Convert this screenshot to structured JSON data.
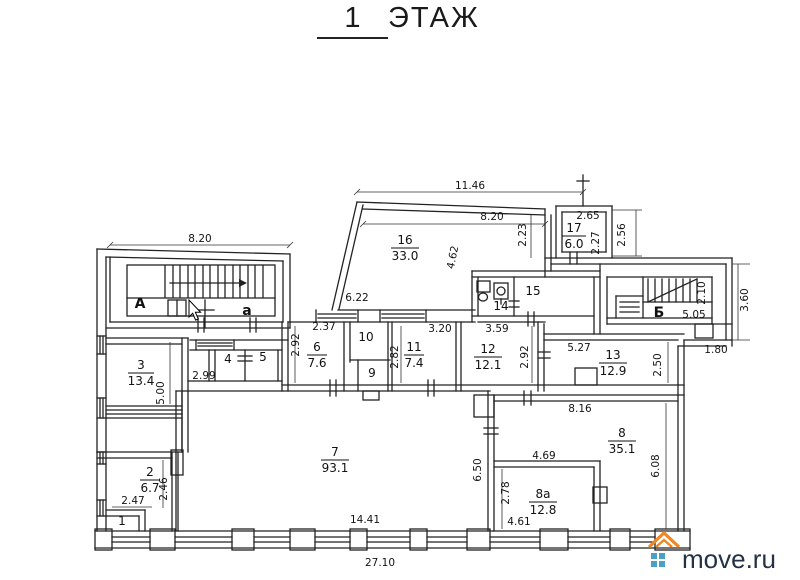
{
  "title": {
    "number": "1",
    "word": "ЭТАЖ"
  },
  "stairs": {
    "left_main": "А",
    "left_small": "а",
    "right": "Б"
  },
  "rooms": {
    "r1": {
      "n": "1"
    },
    "r2": {
      "n": "2",
      "a": "6.7"
    },
    "r3": {
      "n": "3",
      "a": "13.4"
    },
    "r4": {
      "n": "4"
    },
    "r5": {
      "n": "5"
    },
    "r6": {
      "n": "6",
      "a": "7.6"
    },
    "r7": {
      "n": "7",
      "a": "93.1"
    },
    "r8": {
      "n": "8",
      "a": "35.1"
    },
    "r8a": {
      "n": "8а",
      "a": "12.8"
    },
    "r9": {
      "n": "9"
    },
    "r10": {
      "n": "10"
    },
    "r11": {
      "n": "11",
      "a": "7.4"
    },
    "r12": {
      "n": "12",
      "a": "12.1"
    },
    "r13": {
      "n": "13",
      "a": "12.9"
    },
    "r14": {
      "n": "14"
    },
    "r15": {
      "n": "15"
    },
    "r16": {
      "n": "16",
      "a": "33.0"
    },
    "r17": {
      "n": "17",
      "a": "6.0"
    }
  },
  "dims": {
    "entry_top": "8.20",
    "r16_top": "11.46",
    "r16_width": "8.20",
    "r16_niche": "2.23",
    "r16_diag": "4.62",
    "r16_bottom": "6.22",
    "r17_top": "2.65",
    "r17_height": "2.27",
    "r17_side": "2.56",
    "stair_b_width": "2.10",
    "stair_b_len": "5.05",
    "right_side": "3.60",
    "below_stair_b": "1.80",
    "r6_top": "2.37",
    "r6_side": "2.92",
    "r11_top": "3.20",
    "r11_side": "2.82",
    "r12_top": "3.59",
    "r12_side": "2.92",
    "r13_top": "5.27",
    "r13_side": "2.50",
    "hall_width": "2.99",
    "r3_side": "5.00",
    "r8_top": "8.16",
    "r8_side": "6.08",
    "r8a_top": "4.69",
    "r8a_side": "2.78",
    "r8a_bottom": "4.61",
    "r7_side": "6.50",
    "r7_bottom": "14.41",
    "total_bottom": "27.10",
    "r2_side": "2.46",
    "r2_bottom": "2.47"
  },
  "logo": {
    "text": "move.ru",
    "roof_color": "#ef8725",
    "square_color": "#4aa0c6",
    "text_color": "#233247"
  }
}
